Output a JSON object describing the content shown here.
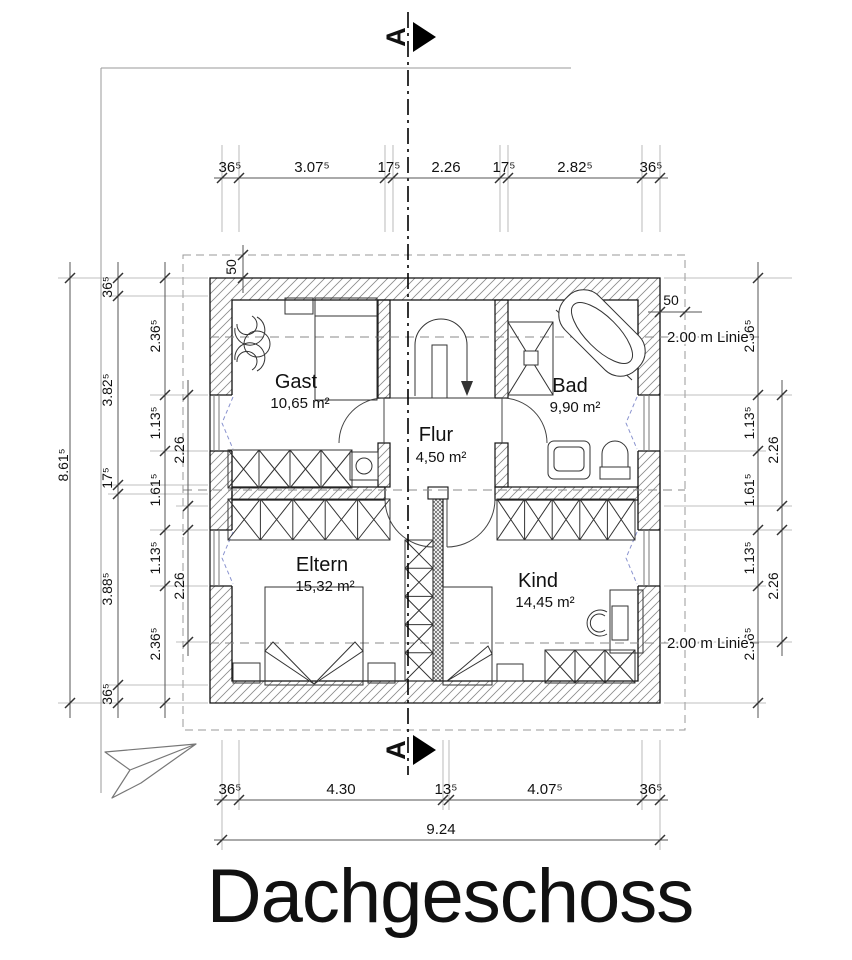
{
  "title": "Dachgeschoss",
  "section": {
    "label": "A"
  },
  "rooms": [
    {
      "name": "Gast",
      "area": "10,65 m²"
    },
    {
      "name": "Flur",
      "area": "4,50 m²"
    },
    {
      "name": "Bad",
      "area": "9,90 m²"
    },
    {
      "name": "Eltern",
      "area": "15,32 m²"
    },
    {
      "name": "Kind",
      "area": "14,45 m²"
    }
  ],
  "dims": {
    "top": [
      "36⁵",
      "3.07⁵",
      "17⁵",
      "2.26",
      "17⁵",
      "2.82⁵",
      "36⁵"
    ],
    "bottom": [
      "36⁵",
      "4.30",
      "13⁵",
      "4.07⁵",
      "36⁵"
    ],
    "total_width": "9.24",
    "total_height": "8.61⁵",
    "left_main": [
      "36⁵",
      "3.82⁵",
      "17⁵",
      "3.88⁵",
      "36⁵"
    ],
    "left_inner": [
      "2.36⁵",
      "1.13⁵",
      "1.61⁵",
      "1.13⁵",
      "2.36⁵"
    ],
    "left_pair": [
      "2.26",
      "2.26"
    ],
    "right_inner": [
      "2.36⁵",
      "1.13⁵",
      "1.61⁵",
      "1.13⁵",
      "2.36⁵"
    ],
    "right_pair": [
      "2.26",
      "2.26"
    ],
    "eaves_top": "50",
    "eaves_right": "50",
    "height_line_top": "2.00 m Linie",
    "height_line_bottom": "2.00 m Linie"
  }
}
